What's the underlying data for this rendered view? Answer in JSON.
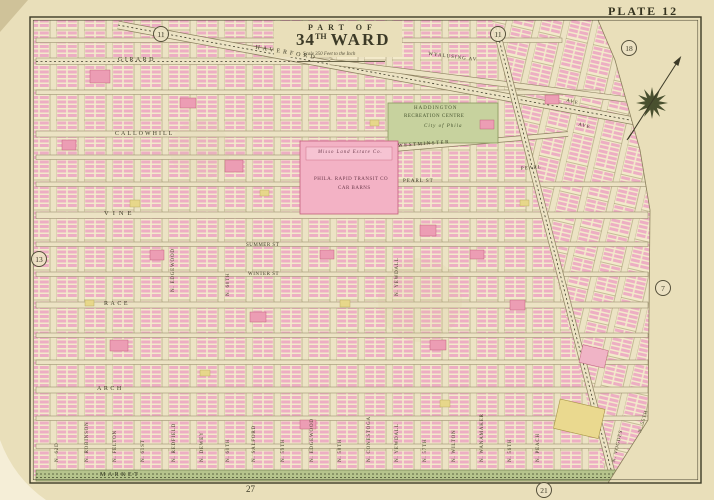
{
  "plate": {
    "label": "PLATE 12"
  },
  "title": {
    "part_of": "PART OF",
    "ward_number": "34",
    "ward_suffix": "TH",
    "ward_word": "WARD",
    "scale_note": "Scale 350 Feet to the Inch"
  },
  "adjacent_plates": {
    "top_left": "11",
    "top_center": "11",
    "top_right": "18",
    "left": "13",
    "right": "7",
    "bottom_center": "27",
    "bottom_right": "21"
  },
  "streets": {
    "horizontal": [
      {
        "name": "GIRARD"
      },
      {
        "name": "HAVERFORD"
      },
      {
        "name": "WYALUSING AV"
      },
      {
        "name": "CALLOWHILL"
      },
      {
        "name": "WESTMINSTER"
      },
      {
        "name": "PEARL ST"
      },
      {
        "name": "PEARL"
      },
      {
        "name": "VINE"
      },
      {
        "name": "SUMMER ST"
      },
      {
        "name": "WINTER ST"
      },
      {
        "name": "RACE"
      },
      {
        "name": "ARCH"
      },
      {
        "name": "MARKET"
      },
      {
        "name": "AVE"
      },
      {
        "name": "AVE"
      }
    ],
    "vertical": [
      {
        "name": "N. 62D"
      },
      {
        "name": "N. ROBINSON"
      },
      {
        "name": "N. FELTON"
      },
      {
        "name": "N. 61ST"
      },
      {
        "name": "N. REDFIELD"
      },
      {
        "name": "N. DEWEY"
      },
      {
        "name": "N. 60TH"
      },
      {
        "name": "N. SALFORD"
      },
      {
        "name": "N. 59TH"
      },
      {
        "name": "N. EDGEWOOD"
      },
      {
        "name": "N. 58TH"
      },
      {
        "name": "N. CONESTOGA"
      },
      {
        "name": "N. YEWDALL"
      },
      {
        "name": "N. 57TH"
      },
      {
        "name": "N. WILTON"
      },
      {
        "name": "N. WANAMAKER"
      },
      {
        "name": "N. 56TH"
      },
      {
        "name": "N. PEACH"
      },
      {
        "name": "N. VOGDES"
      },
      {
        "name": "N. 55TH"
      }
    ]
  },
  "landmarks": {
    "park_line1": "HADDINGTON",
    "park_line2": "RECREATION CENTRE",
    "park_line3": "City of Phila",
    "car_barns_owner": "Misso Land Estate Co.",
    "car_barns_line1": "PHILA. RAPID TRANSIT CO",
    "car_barns_line2": "CAR BARNS"
  },
  "icons": {
    "compass": "north-arrow-compass"
  }
}
